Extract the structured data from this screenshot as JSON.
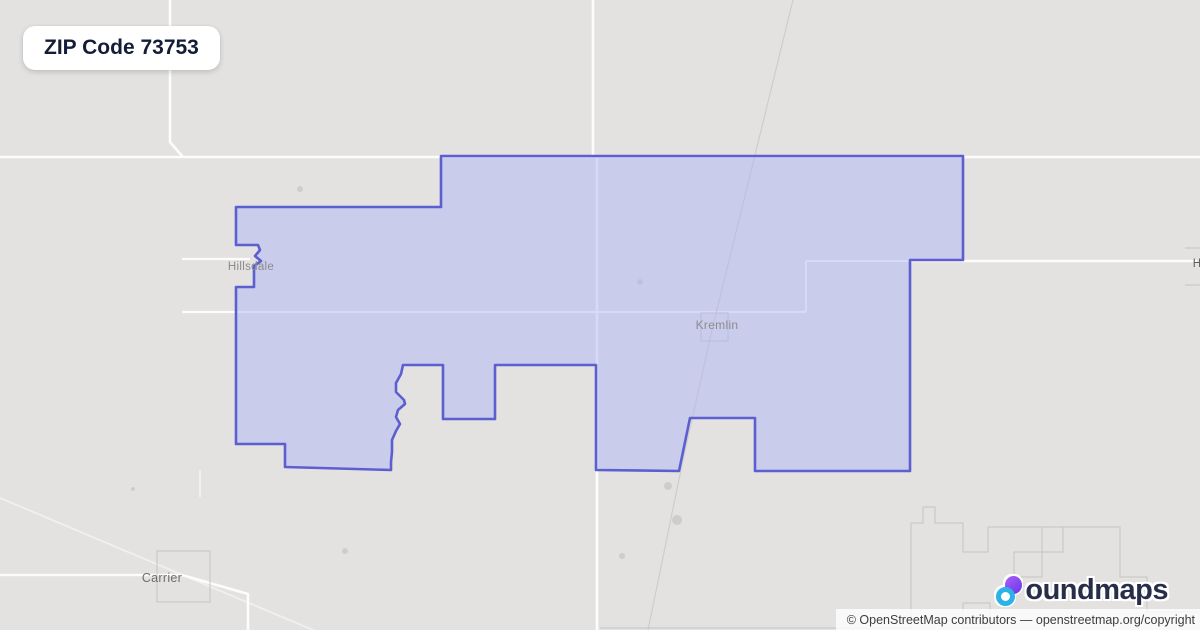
{
  "title": {
    "text": "ZIP Code 73753"
  },
  "attribution": {
    "text": "© OpenStreetMap contributors — openstreetmap.org/copyright"
  },
  "logo": {
    "name": "boundmaps",
    "wordmark_text": "oundmaps",
    "navy": "#272e49",
    "purple": "#7a3df0",
    "cyan": "#2cb2e6"
  },
  "map": {
    "background_color": "#e3e2e1",
    "road_color": "#fcfcfb",
    "railway_color": "#cecdcc",
    "admin_boundary_color": "#c5c4c3",
    "tree_color": "#c9c8c6",
    "zip_boundary": {
      "zip_code": "73753",
      "stroke": "#5b5fd0",
      "stroke_width": 2.6,
      "fill": "rgba(177,182,248,0.5)",
      "points": [
        [
          441,
          156
        ],
        [
          963,
          156
        ],
        [
          963,
          260
        ],
        [
          910,
          260
        ],
        [
          910,
          471
        ],
        [
          755,
          471
        ],
        [
          755,
          418
        ],
        [
          690,
          418
        ],
        [
          679,
          471
        ],
        [
          596,
          470
        ],
        [
          596,
          365
        ],
        [
          495,
          365
        ],
        [
          495,
          419
        ],
        [
          443,
          419
        ],
        [
          443,
          365
        ],
        [
          403,
          365
        ],
        [
          401,
          374
        ],
        [
          396,
          383
        ],
        [
          396,
          392
        ],
        [
          404,
          400
        ],
        [
          405,
          404
        ],
        [
          398,
          410
        ],
        [
          396,
          417
        ],
        [
          400,
          424
        ],
        [
          396,
          431
        ],
        [
          392,
          440
        ],
        [
          392,
          452
        ],
        [
          391,
          462
        ],
        [
          391,
          470
        ],
        [
          285,
          467
        ],
        [
          285,
          444
        ],
        [
          236,
          444
        ],
        [
          236,
          287
        ],
        [
          254,
          287
        ],
        [
          254,
          266
        ],
        [
          261,
          261
        ],
        [
          255,
          256
        ],
        [
          260,
          250
        ],
        [
          258,
          245
        ],
        [
          236,
          245
        ],
        [
          236,
          207
        ],
        [
          441,
          207
        ]
      ]
    },
    "roads": [
      {
        "d": "M0,157 H1200",
        "w": 2.6
      },
      {
        "d": "M170,0 V142 L183,157",
        "w": 2.6
      },
      {
        "d": "M593,0 V157",
        "w": 2.6
      },
      {
        "d": "M597,157 V630",
        "w": 2.6
      },
      {
        "d": "M182,312 H806",
        "w": 2.2
      },
      {
        "d": "M182,259 H250",
        "w": 2.2
      },
      {
        "d": "M910,261 H1197",
        "w": 2.6
      },
      {
        "d": "M806,261 H910",
        "w": 2.0
      },
      {
        "d": "M806,261 V312",
        "w": 2.0
      },
      {
        "d": "M0,575 H182 L248,594 V630",
        "w": 2.6
      },
      {
        "d": "M200,470 V497",
        "w": 1.6,
        "o": 0.7
      },
      {
        "d": "M0,498 L332,638",
        "w": 1.8,
        "o": 0.55
      }
    ],
    "railways": [
      {
        "d": "M793,0 L755,155 L712,330 L683,460 L648,630",
        "w": 1.2
      }
    ],
    "admin_shapes": [
      {
        "name": "kremlin-town-box",
        "d": "M701,313 h27 v28 h-27 z"
      },
      {
        "name": "carrier-town-box",
        "d": "M157,551 h53 v51 h-53 z"
      },
      {
        "name": "hunter-town-box",
        "d": "M1185,248 h22 v37 h-22"
      },
      {
        "name": "se-boundary",
        "d": "M911,632 V523 H923 V507 H935 V523 H963 V552 H988 V527 H1120 V577 H1147 V612 H1200"
      },
      {
        "name": "se-box-1",
        "d": "M1014,552 h28 v25 h-28 z"
      },
      {
        "name": "se-box-2",
        "d": "M963,603 h27 v25 h-27 z"
      },
      {
        "name": "se-box-3",
        "d": "M1042,527 h21 v25 h-21 z"
      },
      {
        "name": "se-faint-line",
        "d": "M600,628 H911"
      }
    ],
    "trees": [
      [
        668,
        486,
        4
      ],
      [
        677,
        520,
        5
      ],
      [
        622,
        556,
        3
      ],
      [
        640,
        282,
        3
      ],
      [
        345,
        551,
        3
      ],
      [
        300,
        189,
        3
      ],
      [
        133,
        489,
        2
      ]
    ],
    "labels": [
      {
        "text": "Hillsdale",
        "x": 251,
        "y": 267,
        "size": 11.5,
        "color": "#8c8c8c"
      },
      {
        "text": "Kremlin",
        "x": 717,
        "y": 325,
        "size": 12,
        "color": "#8c8c8c"
      },
      {
        "text": "Carrier",
        "x": 162,
        "y": 578,
        "size": 12.5,
        "color": "#6e6e6e"
      },
      {
        "text": "H",
        "x": 1197,
        "y": 264,
        "size": 11.5,
        "color": "#5f5f5f"
      }
    ]
  }
}
